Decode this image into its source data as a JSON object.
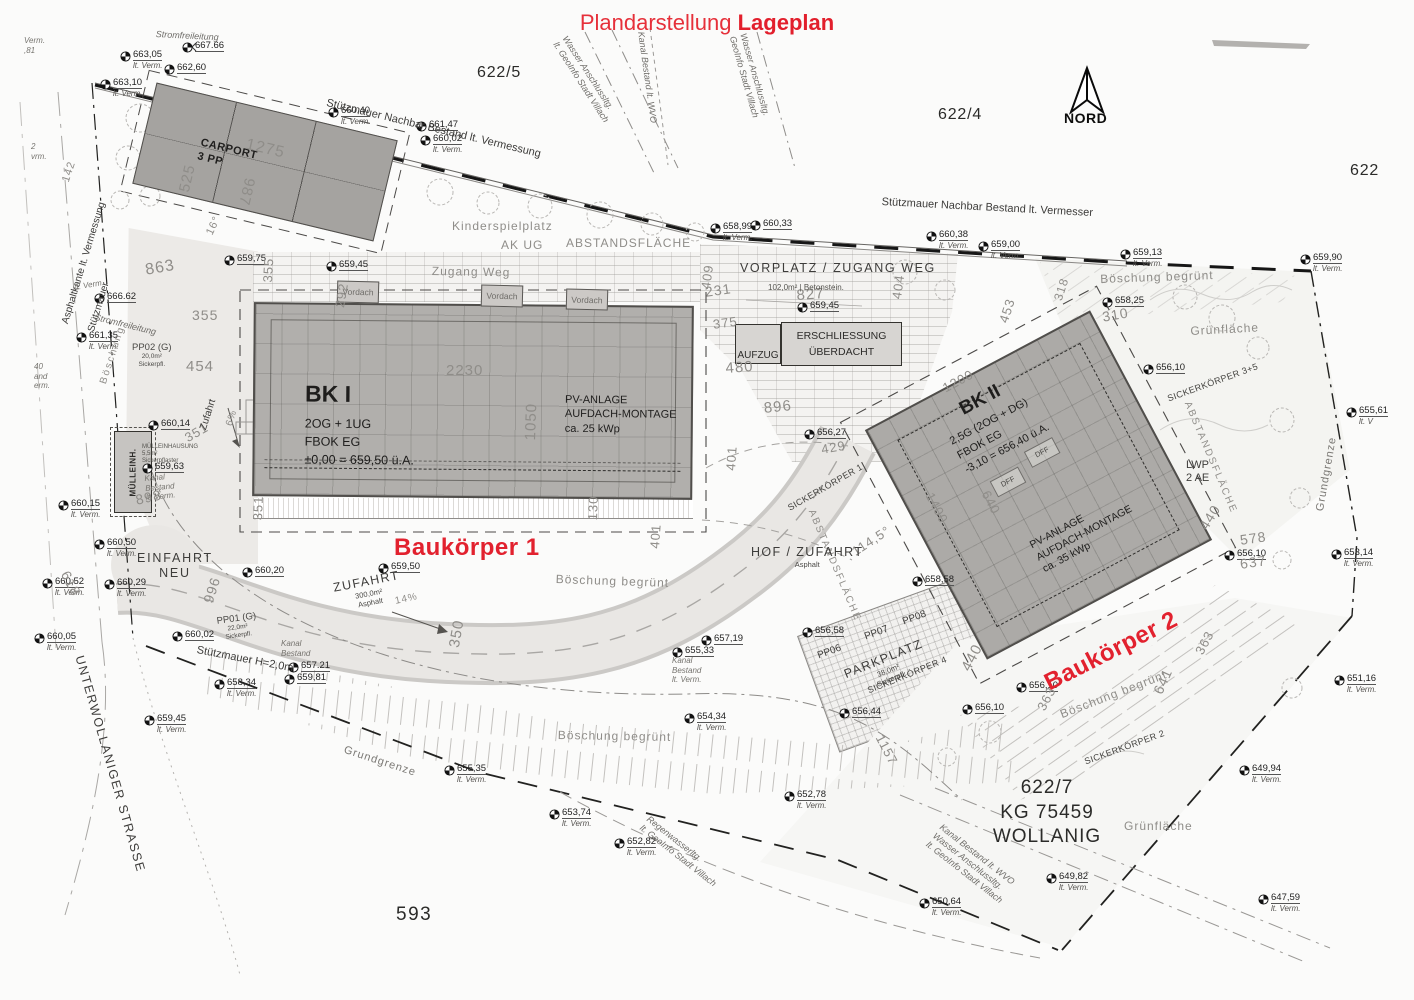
{
  "title": {
    "prefix": "Plandarstellung",
    "bold": "Lageplan"
  },
  "north": {
    "label": "NORD"
  },
  "parcels": {
    "p622_5": "622/5",
    "p622_4": "622/4",
    "p622": "622",
    "p593": "593",
    "p622_7": {
      "number": "622/7",
      "kg": "KG 75459",
      "name": "WOLLANIG"
    }
  },
  "red_labels": {
    "bk1": "Baukörper 1",
    "bk2": "Baukörper 2"
  },
  "buildings": {
    "carport": {
      "name": "CARPORT",
      "sub": "3 PP"
    },
    "bk1": {
      "name": "BK I",
      "line1": "2OG + 1UG",
      "line2": "FBOK EG",
      "line3": "±0,00 = 659,50 ü.A.",
      "pv1": "PV-ANLAGE",
      "pv2": "AUFDACH-MONTAGE",
      "pv3": "ca. 25 kWp"
    },
    "bk2": {
      "name": "BK II",
      "line1": "2,5G (2OG + DG)",
      "line2": "FBOK EG",
      "line3": "-3,10 = 656,40 ü.A.",
      "pv1": "PV-ANLAGE",
      "pv2": "AUFDACH-MONTAGE",
      "pv3": "ca. 35 kWp",
      "dff": "DFF"
    }
  },
  "boxes": {
    "aufzug": "AUFZUG",
    "erschliessung1": "ERSCHLIESSUNG",
    "erschliessung2": "ÜBERDACHT",
    "muelleinh": "MÜLLEINH.",
    "vordach": "Vordach"
  },
  "surveys": [
    {
      "v": "663,05",
      "s": "lt. Verm."
    },
    {
      "v": "662,60"
    },
    {
      "v": "663,10",
      "s": "lt. Verm."
    },
    {
      "v": "667.66"
    },
    {
      "v": "660,40",
      "s": "lt. Verm."
    },
    {
      "v": "661,47"
    },
    {
      "v": "660,02",
      "s": "lt. Verm."
    },
    {
      "v": "658,99",
      "s": "lt. Verm."
    },
    {
      "v": "660,33"
    },
    {
      "v": "660,38",
      "s": "lt. Verm."
    },
    {
      "v": "659,00",
      "s": "lt. Verm."
    },
    {
      "v": "659,13",
      "s": "lt. Verm."
    },
    {
      "v": "659,90",
      "s": "lt. Verm."
    },
    {
      "v": "658,25"
    },
    {
      "v": "659,45"
    },
    {
      "v": "659,75"
    },
    {
      "v": "656,10"
    },
    {
      "v": "655,61",
      "s": "lt. V"
    },
    {
      "v": "653,14",
      "s": "lt. Verm."
    },
    {
      "v": "656,10"
    },
    {
      "v": "651,16",
      "s": "lt. Verm."
    },
    {
      "v": "649,94",
      "s": "lt. Verm."
    },
    {
      "v": "647,59",
      "s": "lt. Verm."
    },
    {
      "v": "649,82",
      "s": "lt. Verm."
    },
    {
      "v": "650,64",
      "s": "lt. Verm."
    },
    {
      "v": "652,78",
      "s": "lt. Verm."
    },
    {
      "v": "653,74",
      "s": "lt. Verm."
    },
    {
      "v": "652,82",
      "s": "lt. Verm."
    },
    {
      "v": "655,35",
      "s": "lt. Verm."
    },
    {
      "v": "654,34",
      "s": "lt. Verm."
    },
    {
      "v": "657,19"
    },
    {
      "v": "656,27"
    },
    {
      "v": "659,45"
    },
    {
      "v": "658,58"
    },
    {
      "v": "656,58"
    },
    {
      "v": "656,44"
    },
    {
      "v": "656,10"
    },
    {
      "v": "656,10"
    },
    {
      "v": "660,14"
    },
    {
      "v": "659,63"
    },
    {
      "v": "660,15",
      "s": "lt. Verm."
    },
    {
      "v": "660,50",
      "s": "lt. Verm."
    },
    {
      "v": "660,20"
    },
    {
      "v": "659,50"
    },
    {
      "v": "660,52",
      "s": "lt. Verm."
    },
    {
      "v": "660,29",
      "s": "lt. Verm."
    },
    {
      "v": "660,05",
      "s": "lt. Verm."
    },
    {
      "v": "660,02"
    },
    {
      "v": "658,34",
      "s": "lt. Verm."
    },
    {
      "v": "659,81"
    },
    {
      "v": "659,45",
      "s": "lt. Verm."
    },
    {
      "v": "661,35",
      "s": "lt. Verm."
    },
    {
      "v": "666.62"
    },
    {
      "v": "657.21"
    },
    {
      "v": "655,33"
    }
  ],
  "dims": [
    "1275",
    "525",
    "987",
    "863",
    "355",
    "292",
    "355",
    "454",
    "351",
    "898",
    "996",
    "618",
    "350",
    "2230",
    "1050",
    "130",
    "351",
    "401",
    "401",
    "409",
    "231",
    "827",
    "375",
    "480",
    "896",
    "404",
    "453",
    "318",
    "310",
    "1200",
    "1400",
    "640",
    "440",
    "440",
    "578",
    "637",
    "363",
    "363",
    "641",
    "1157",
    "429",
    "16°",
    "114,5°",
    "6%",
    "14%",
    "142"
  ],
  "notes": [
    {
      "lines": [
        "Stützmauer Nachbar Bestand lt. Vermessung"
      ]
    },
    {
      "lines": [
        "Stützmauer Nachbar Bestand lt. Vermesser"
      ]
    },
    {
      "lines": [
        "Asphaltkante lt. Vermessung"
      ]
    },
    {
      "lines": [
        "Stützmauer"
      ]
    },
    {
      "lines": [
        "Stromfreileitung"
      ]
    },
    {
      "lines": [
        "Stromfreileitung"
      ]
    },
    {
      "lines": [
        "Kinderspielplatz"
      ]
    },
    {
      "lines": [
        "AK UG"
      ]
    },
    {
      "lines": [
        "ABSTANDSFLÄCHE"
      ]
    },
    {
      "lines": [
        "Zugang Weg"
      ]
    },
    {
      "lines": [
        "VORPLATZ / ZUGANG WEG"
      ]
    },
    {
      "lines": [
        "102,0m² | Betonstein."
      ]
    },
    {
      "lines": [
        "Böschung begrünt"
      ]
    },
    {
      "lines": [
        "Grünfläche"
      ]
    },
    {
      "lines": [
        "Grünfläche"
      ]
    },
    {
      "lines": [
        "Böschung begrünt"
      ]
    },
    {
      "lines": [
        "Böschung begrünt"
      ]
    },
    {
      "lines": [
        "Böschung begrünt"
      ]
    },
    {
      "lines": [
        "SICKERKÖRPER 1"
      ]
    },
    {
      "lines": [
        "SICKERKÖRPER 2"
      ]
    },
    {
      "lines": [
        "SICKERKÖRPER 4"
      ]
    },
    {
      "lines": [
        "SICKERKÖRPER 3+5"
      ]
    },
    {
      "lines": [
        "ABSTANDSFLÄCHE"
      ]
    },
    {
      "lines": [
        "ABSTANDSFLÄCHE"
      ]
    },
    {
      "lines": [
        "HOF / ZUFAHRT",
        "Asphalt"
      ]
    },
    {
      "lines": [
        "EINFAHRT",
        "NEU"
      ]
    },
    {
      "lines": [
        "ZUFAHRT",
        "300,0m²",
        "Asphalt"
      ]
    },
    {
      "lines": [
        "PP01 (G)",
        "22,0m²",
        "Sickerpfl."
      ]
    },
    {
      "lines": [
        "PP02 (G)",
        "20,0m²",
        "Sickerpfl."
      ]
    },
    {
      "lines": [
        "PP06"
      ]
    },
    {
      "lines": [
        "PP07"
      ]
    },
    {
      "lines": [
        "PP08"
      ]
    },
    {
      "lines": [
        "PARKPLATZ",
        "38,0m²",
        "Sickerpfl."
      ]
    },
    {
      "lines": [
        "Zufahrt"
      ]
    },
    {
      "lines": [
        "Böschung"
      ]
    },
    {
      "lines": [
        "UNTERWOLLANIGER STRASSE"
      ]
    },
    {
      "lines": [
        "Grundgrenze"
      ]
    },
    {
      "lines": [
        "Grundgrenze"
      ]
    },
    {
      "lines": [
        "Stützmauer H=2,0m"
      ]
    },
    {
      "lines": [
        "Kanal",
        "Bestand"
      ]
    },
    {
      "lines": [
        "Kanal",
        "Bestand",
        "lt. Verm."
      ]
    },
    {
      "lines": [
        "MÜLLEINHAUSUNG",
        "5,5m²",
        "Sickerpflaster"
      ]
    },
    {
      "lines": [
        "Regenwasserltg.",
        "lt. GeoInfo Stadt Villach"
      ]
    },
    {
      "lines": [
        "Kanal Bestand lt. WVO",
        "Wasser Anschlussltg.",
        "lt. GeoInfo Stadt Villach"
      ]
    },
    {
      "lines": [
        "Wasser Anschlussltg.",
        "lt. GeoInfo Stadt Villach"
      ]
    },
    {
      "lines": [
        "Kanal Bestand lt. WVO"
      ]
    },
    {
      "lines": [
        "Wasser Anschlussltg.",
        "GeoInfo Stadt Villach"
      ]
    },
    {
      "lines": [
        "LWP",
        "2 AE"
      ]
    },
    {
      "lines": [
        "Verm.",
        ",81"
      ]
    },
    {
      "lines": [
        "2",
        "vrm."
      ]
    },
    {
      "lines": [
        "40",
        "and",
        "erm."
      ]
    },
    {
      "lines": [
        "lt. Verm."
      ]
    },
    {
      "lines": [
        "Kanal",
        "Bestand",
        "lt. Verm."
      ]
    }
  ],
  "colors": {
    "red": "#e2212e",
    "building_gray": "#b1afac",
    "dim_gray": "#8f8d89",
    "line_dark": "#222220"
  }
}
